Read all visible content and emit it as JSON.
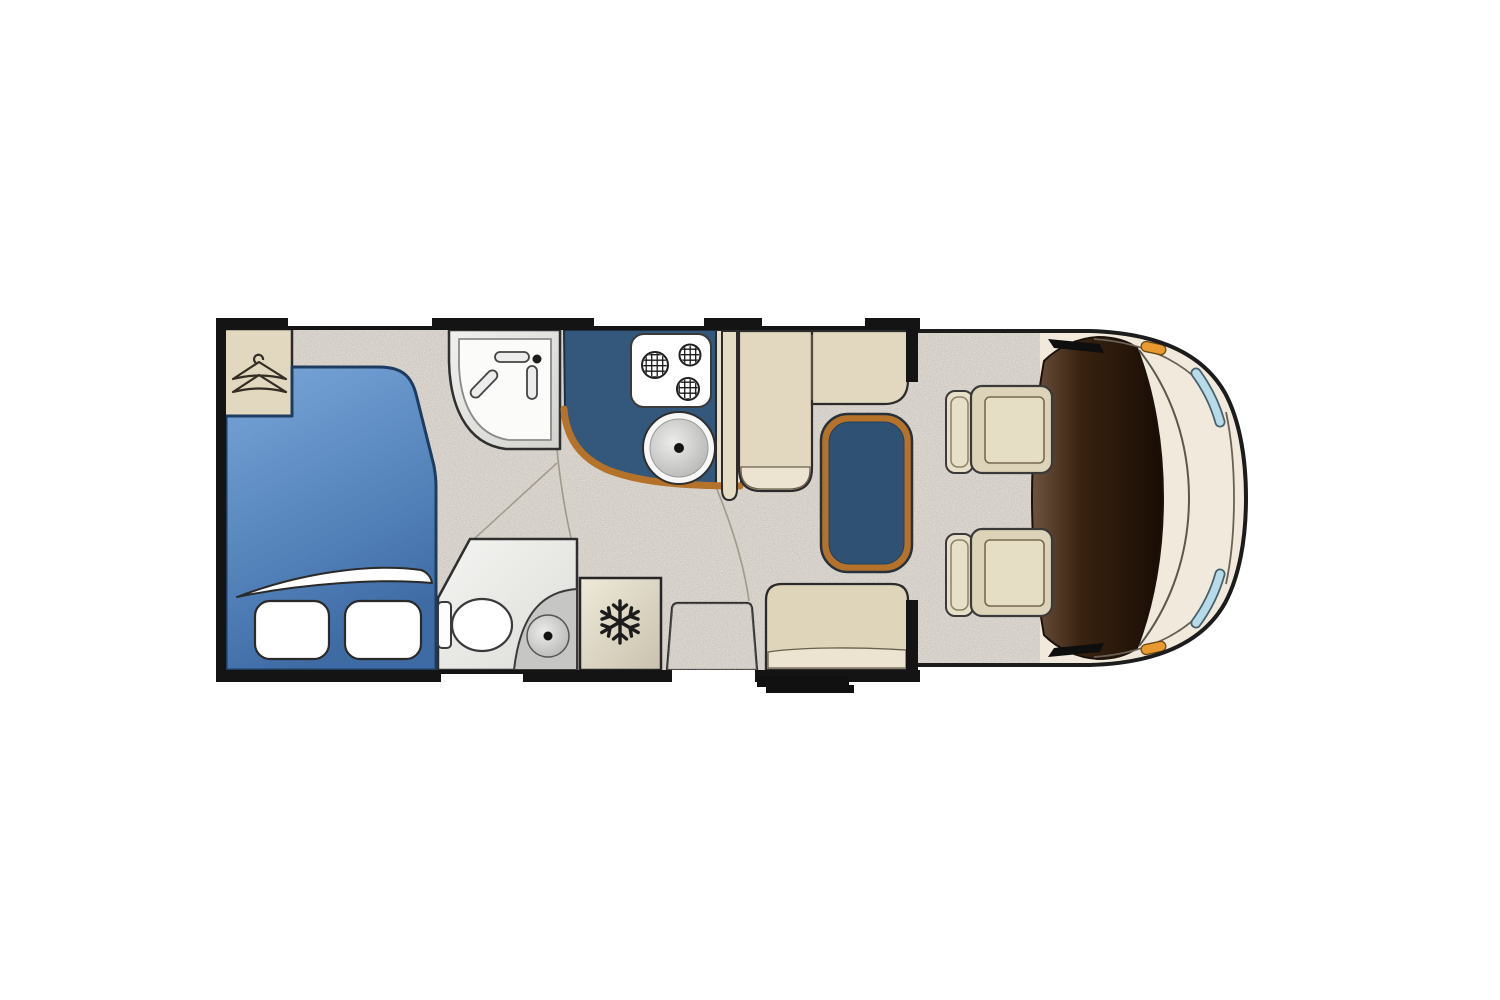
{
  "meta": {
    "description": "Top-down floor plan of a motorhome (camper) with rear bedroom, washroom, kitchen, dinette and driving cab",
    "canvas": {
      "width": 1500,
      "height": 1000
    }
  },
  "colors": {
    "background": "#ffffff",
    "wall": "#141414",
    "carpet": "#e4dfd8",
    "bed_light": "#7aa6d9",
    "bed_mid": "#5b8ac1",
    "bed_dark": "#3f6ba4",
    "bed_outline": "#1e3c60",
    "pillow": "#ffffff",
    "furniture_beige": "#e2d8bf",
    "furniture_beige_light": "#ece4d0",
    "furniture_outline": "#2b2b2b",
    "counter_blue": "#33587c",
    "table_blue": "#2e5174",
    "wood_trim": "#b5722a",
    "bathroom_white": "#f4f4f2",
    "bathroom_grey": "#c6c6c4",
    "fridge_light": "#efe9d9",
    "fridge_dark": "#c9c2ae",
    "icon_black": "#1c1c1c",
    "cab_body": "#f0e9dc",
    "cab_outline": "#1c1c1c",
    "dash_light": "#6e5340",
    "dash_dark": "#190c05",
    "windshield_tint": "#b7dbe9",
    "indicator_orange": "#e89a30",
    "seat_beige": "#ddd3b8",
    "seat_back_beige": "#e8dfc8"
  },
  "floorplan": {
    "vehicle": "motorhome",
    "view": "top-down",
    "zones": [
      {
        "id": "bedroom",
        "items": [
          "double-bed",
          "two-pillows",
          "folded-sheet",
          "wardrobe"
        ]
      },
      {
        "id": "washroom",
        "items": [
          "corner-shower",
          "toilet",
          "washbasin"
        ]
      },
      {
        "id": "kitchen",
        "items": [
          "three-burner-hob",
          "round-sink",
          "l-shaped-worktop",
          "refrigerator"
        ]
      },
      {
        "id": "lounge",
        "items": [
          "l-shaped-bench",
          "pedestal-table",
          "rear-bench",
          "entry-step-mat",
          "exterior-step"
        ]
      },
      {
        "id": "cab",
        "items": [
          "driver-seat",
          "passenger-seat",
          "dashboard",
          "windscreen",
          "door-mirrors"
        ]
      }
    ],
    "icons": [
      "hanger-icon",
      "shower-fixture-icon",
      "hob-burners-icon",
      "sink-drain-icon",
      "toilet-icon",
      "snowflake-icon"
    ]
  }
}
